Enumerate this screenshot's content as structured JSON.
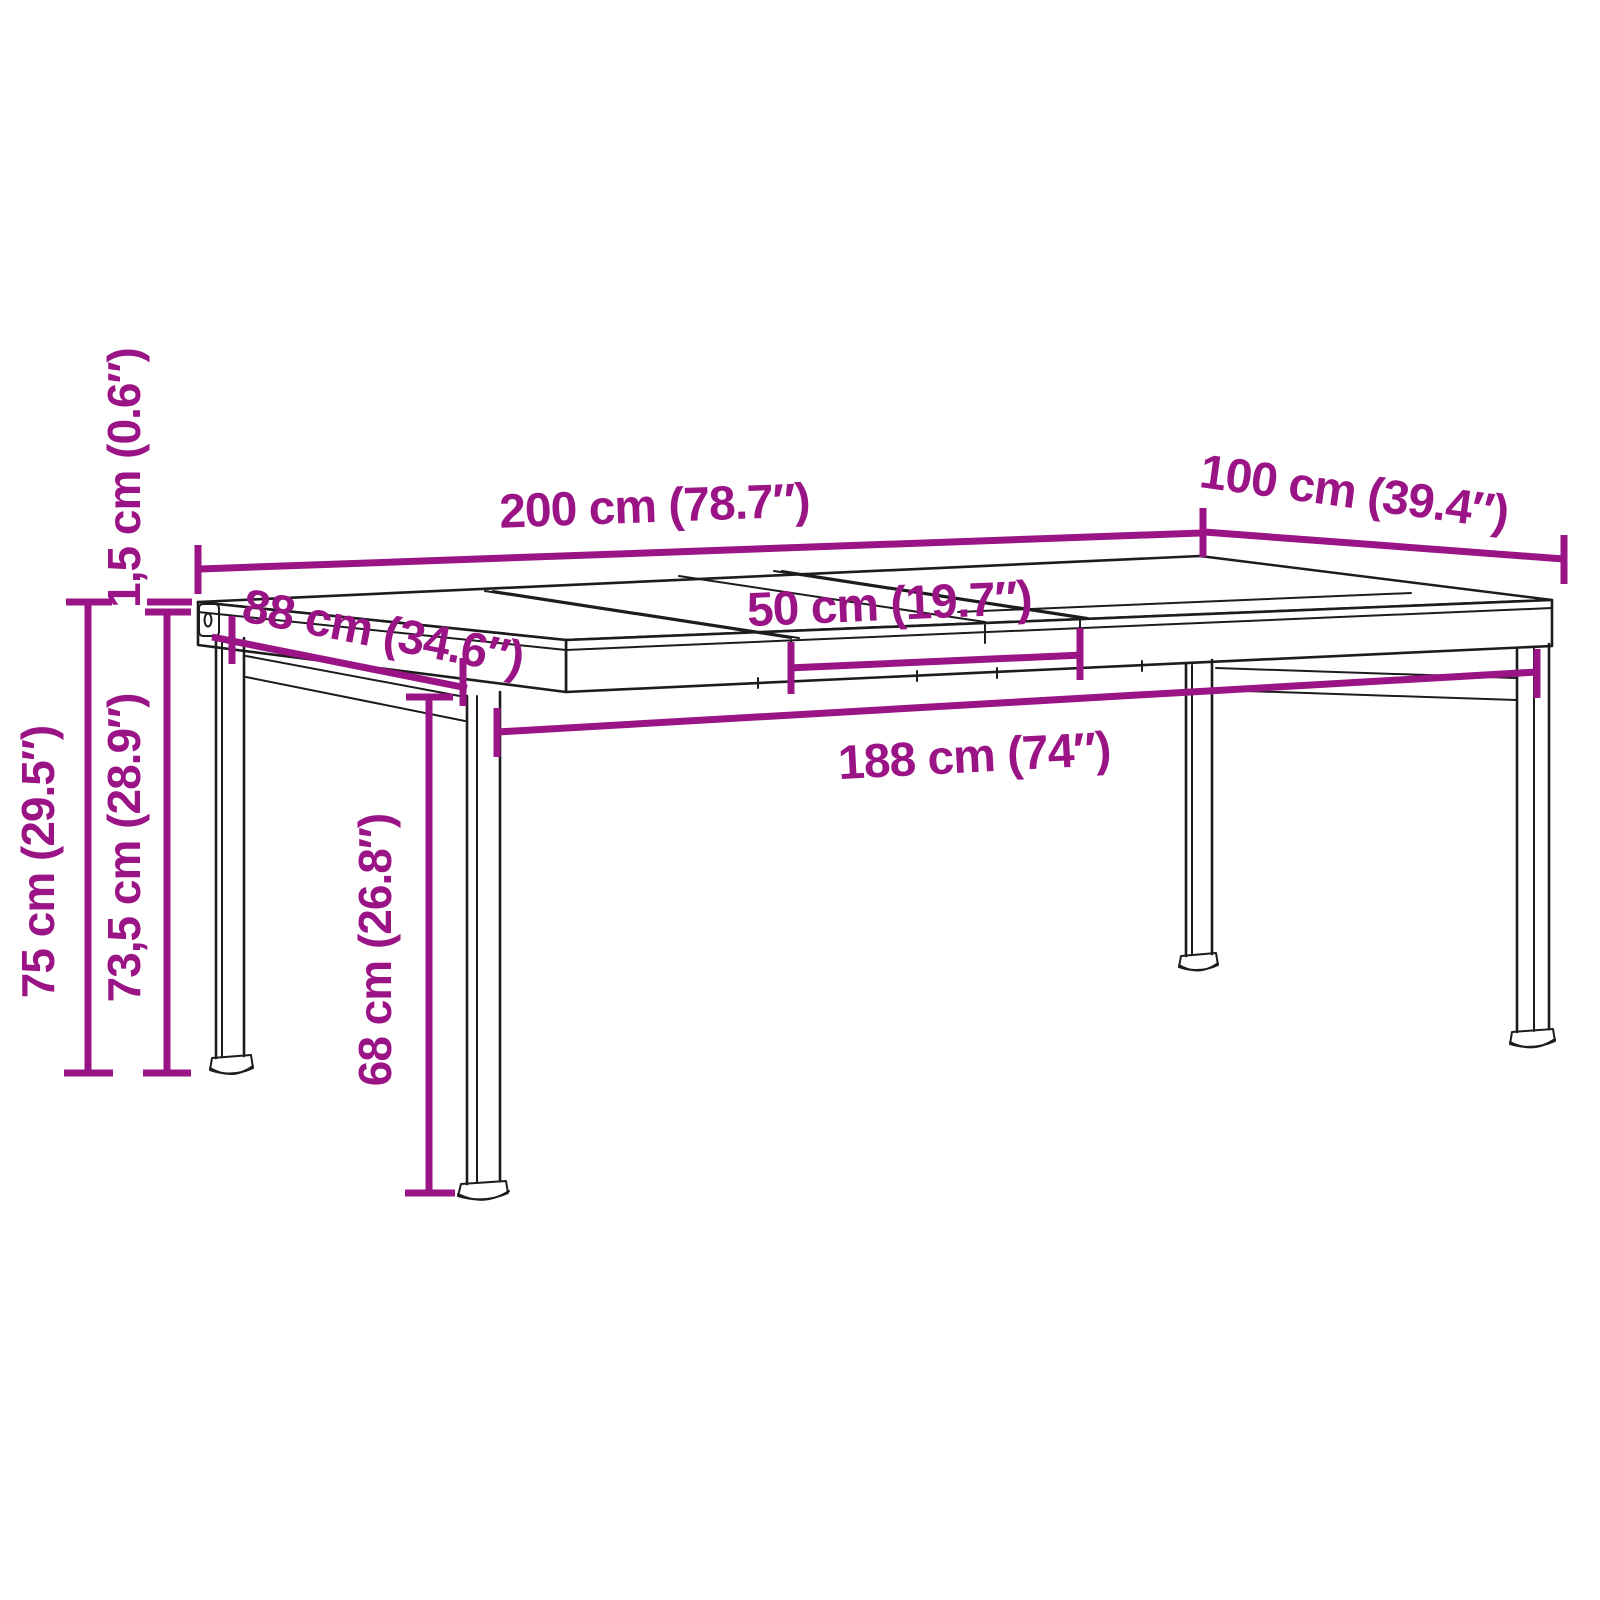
{
  "diagram": {
    "kind": "furniture-dimension-diagram",
    "subject": "extendable dining table line drawing",
    "colors": {
      "accent": "#9A1486",
      "ink": "#1C1C1C",
      "background": "#FFFFFF"
    },
    "labels": {
      "top_length": "200 cm (78.7″)",
      "top_depth": "100 cm (39.4″)",
      "leg_span_depth": "88 cm (34.6″)",
      "extension_leaf": "50 cm (19.7″)",
      "leg_span_length": "188 cm (74″)",
      "total_height": "75 cm (29.5″)",
      "height_under_top": "73,5 cm (28.9″)",
      "top_thickness": "1,5 cm (0.6″)",
      "leg_height": "68 cm (26.8″)"
    }
  }
}
